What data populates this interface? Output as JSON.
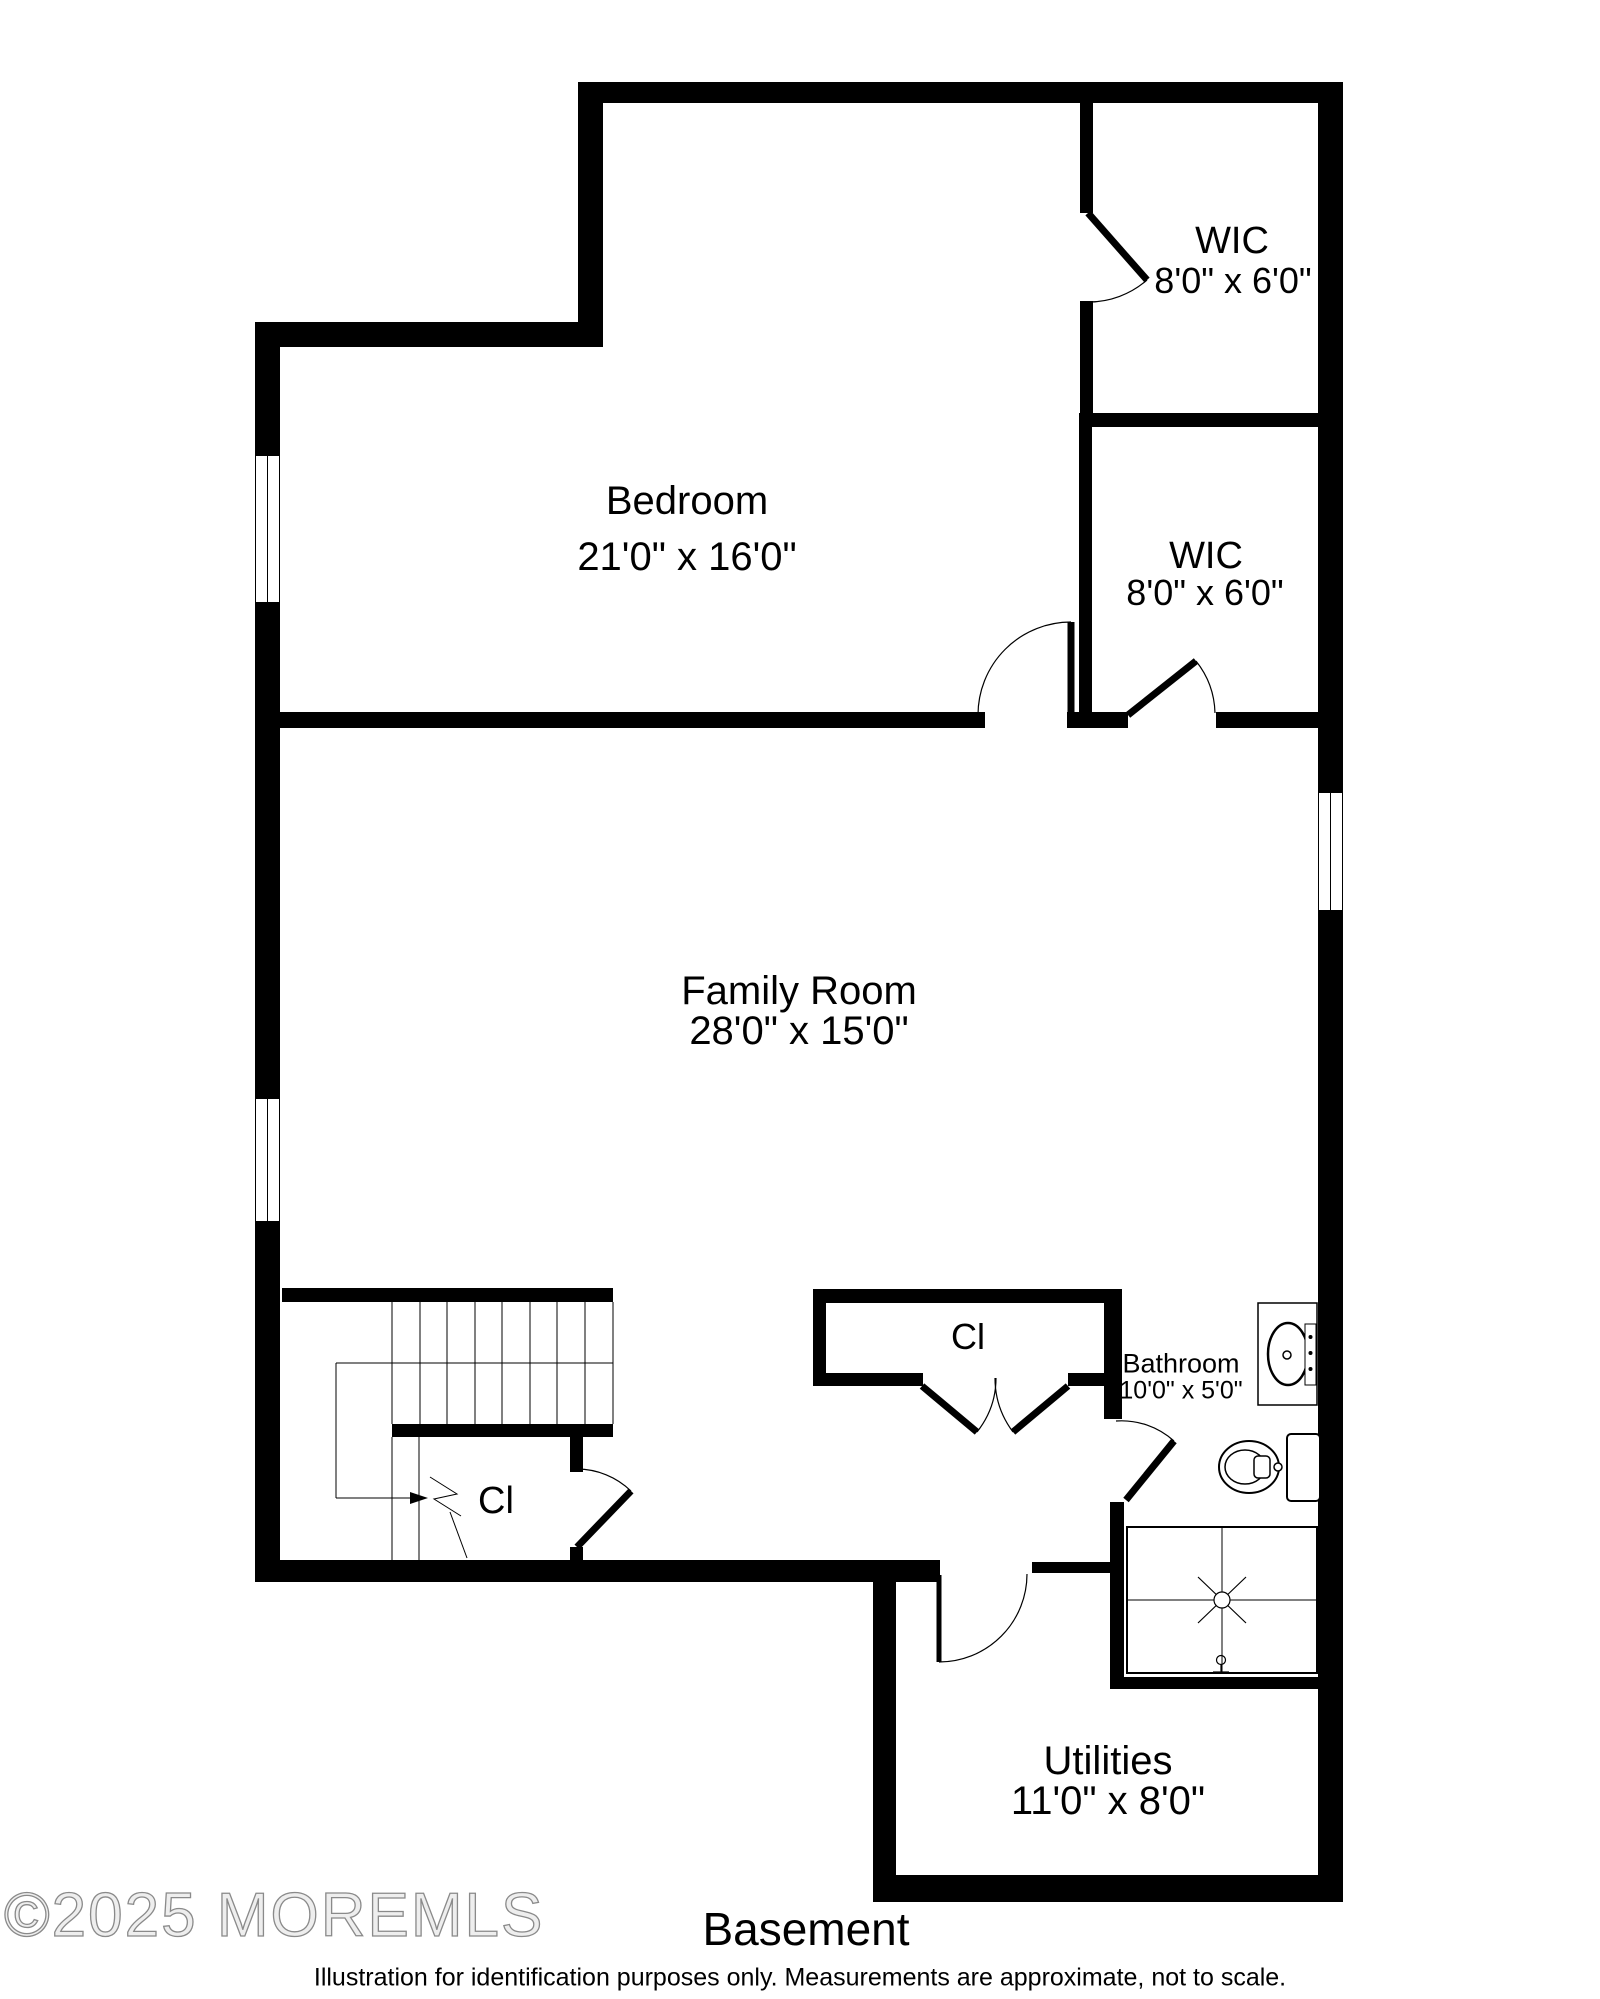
{
  "floor_plan": {
    "title": "Basement",
    "disclaimer": "Illustration for identification purposes only. Measurements are approximate, not to scale.",
    "watermark": "©2025 MOREMLS",
    "rooms": {
      "bedroom": {
        "name": "Bedroom",
        "dims": "21'0\" x 16'0\""
      },
      "wic_top": {
        "name": "WIC",
        "dims": "8'0\" x 6'0\""
      },
      "wic_middle": {
        "name": "WIC",
        "dims": "8'0\" x 6'0\""
      },
      "family_room": {
        "name": "Family Room",
        "dims": "28'0\" x 15'0\""
      },
      "closet_stairs": {
        "name": "Cl"
      },
      "closet_hall": {
        "name": "Cl"
      },
      "bathroom": {
        "name": "Bathroom",
        "dims": "10'0\" x 5'0\""
      },
      "utilities": {
        "name": "Utilities",
        "dims": "11'0\" x 8'0\""
      }
    },
    "colors": {
      "wall": "#000000",
      "background": "#ffffff",
      "watermark_outline": "#8a8a8a"
    }
  }
}
